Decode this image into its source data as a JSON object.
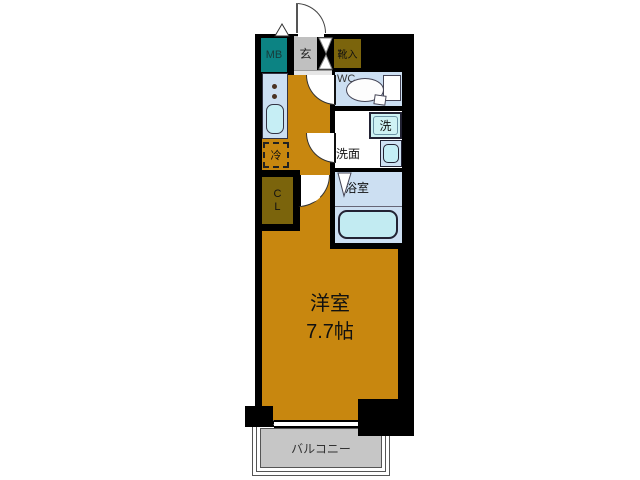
{
  "floor_plan": {
    "labels": {
      "meter_box": "MB",
      "entrance": "玄",
      "shoe_cabinet": "靴入",
      "toilet": "WC",
      "washer": "洗",
      "washroom": "洗面",
      "bathroom": "浴室",
      "refrigerator": "冷",
      "closet_top": "C",
      "closet_bottom": "L",
      "room_name": "洋室",
      "room_size": "7.7帖",
      "balcony": "バルコニー"
    },
    "colors": {
      "wall": "#000000",
      "flooring_orange": "#c8870f",
      "meter_box_teal": "#0c8383",
      "storage_olive": "#7b640c",
      "entrance_gray": "#c0c0c0",
      "wet_area_blue": "#ccdff2",
      "fixture_cyan": "#c6eef5",
      "balcony_gray": "#c6c6c6"
    }
  }
}
